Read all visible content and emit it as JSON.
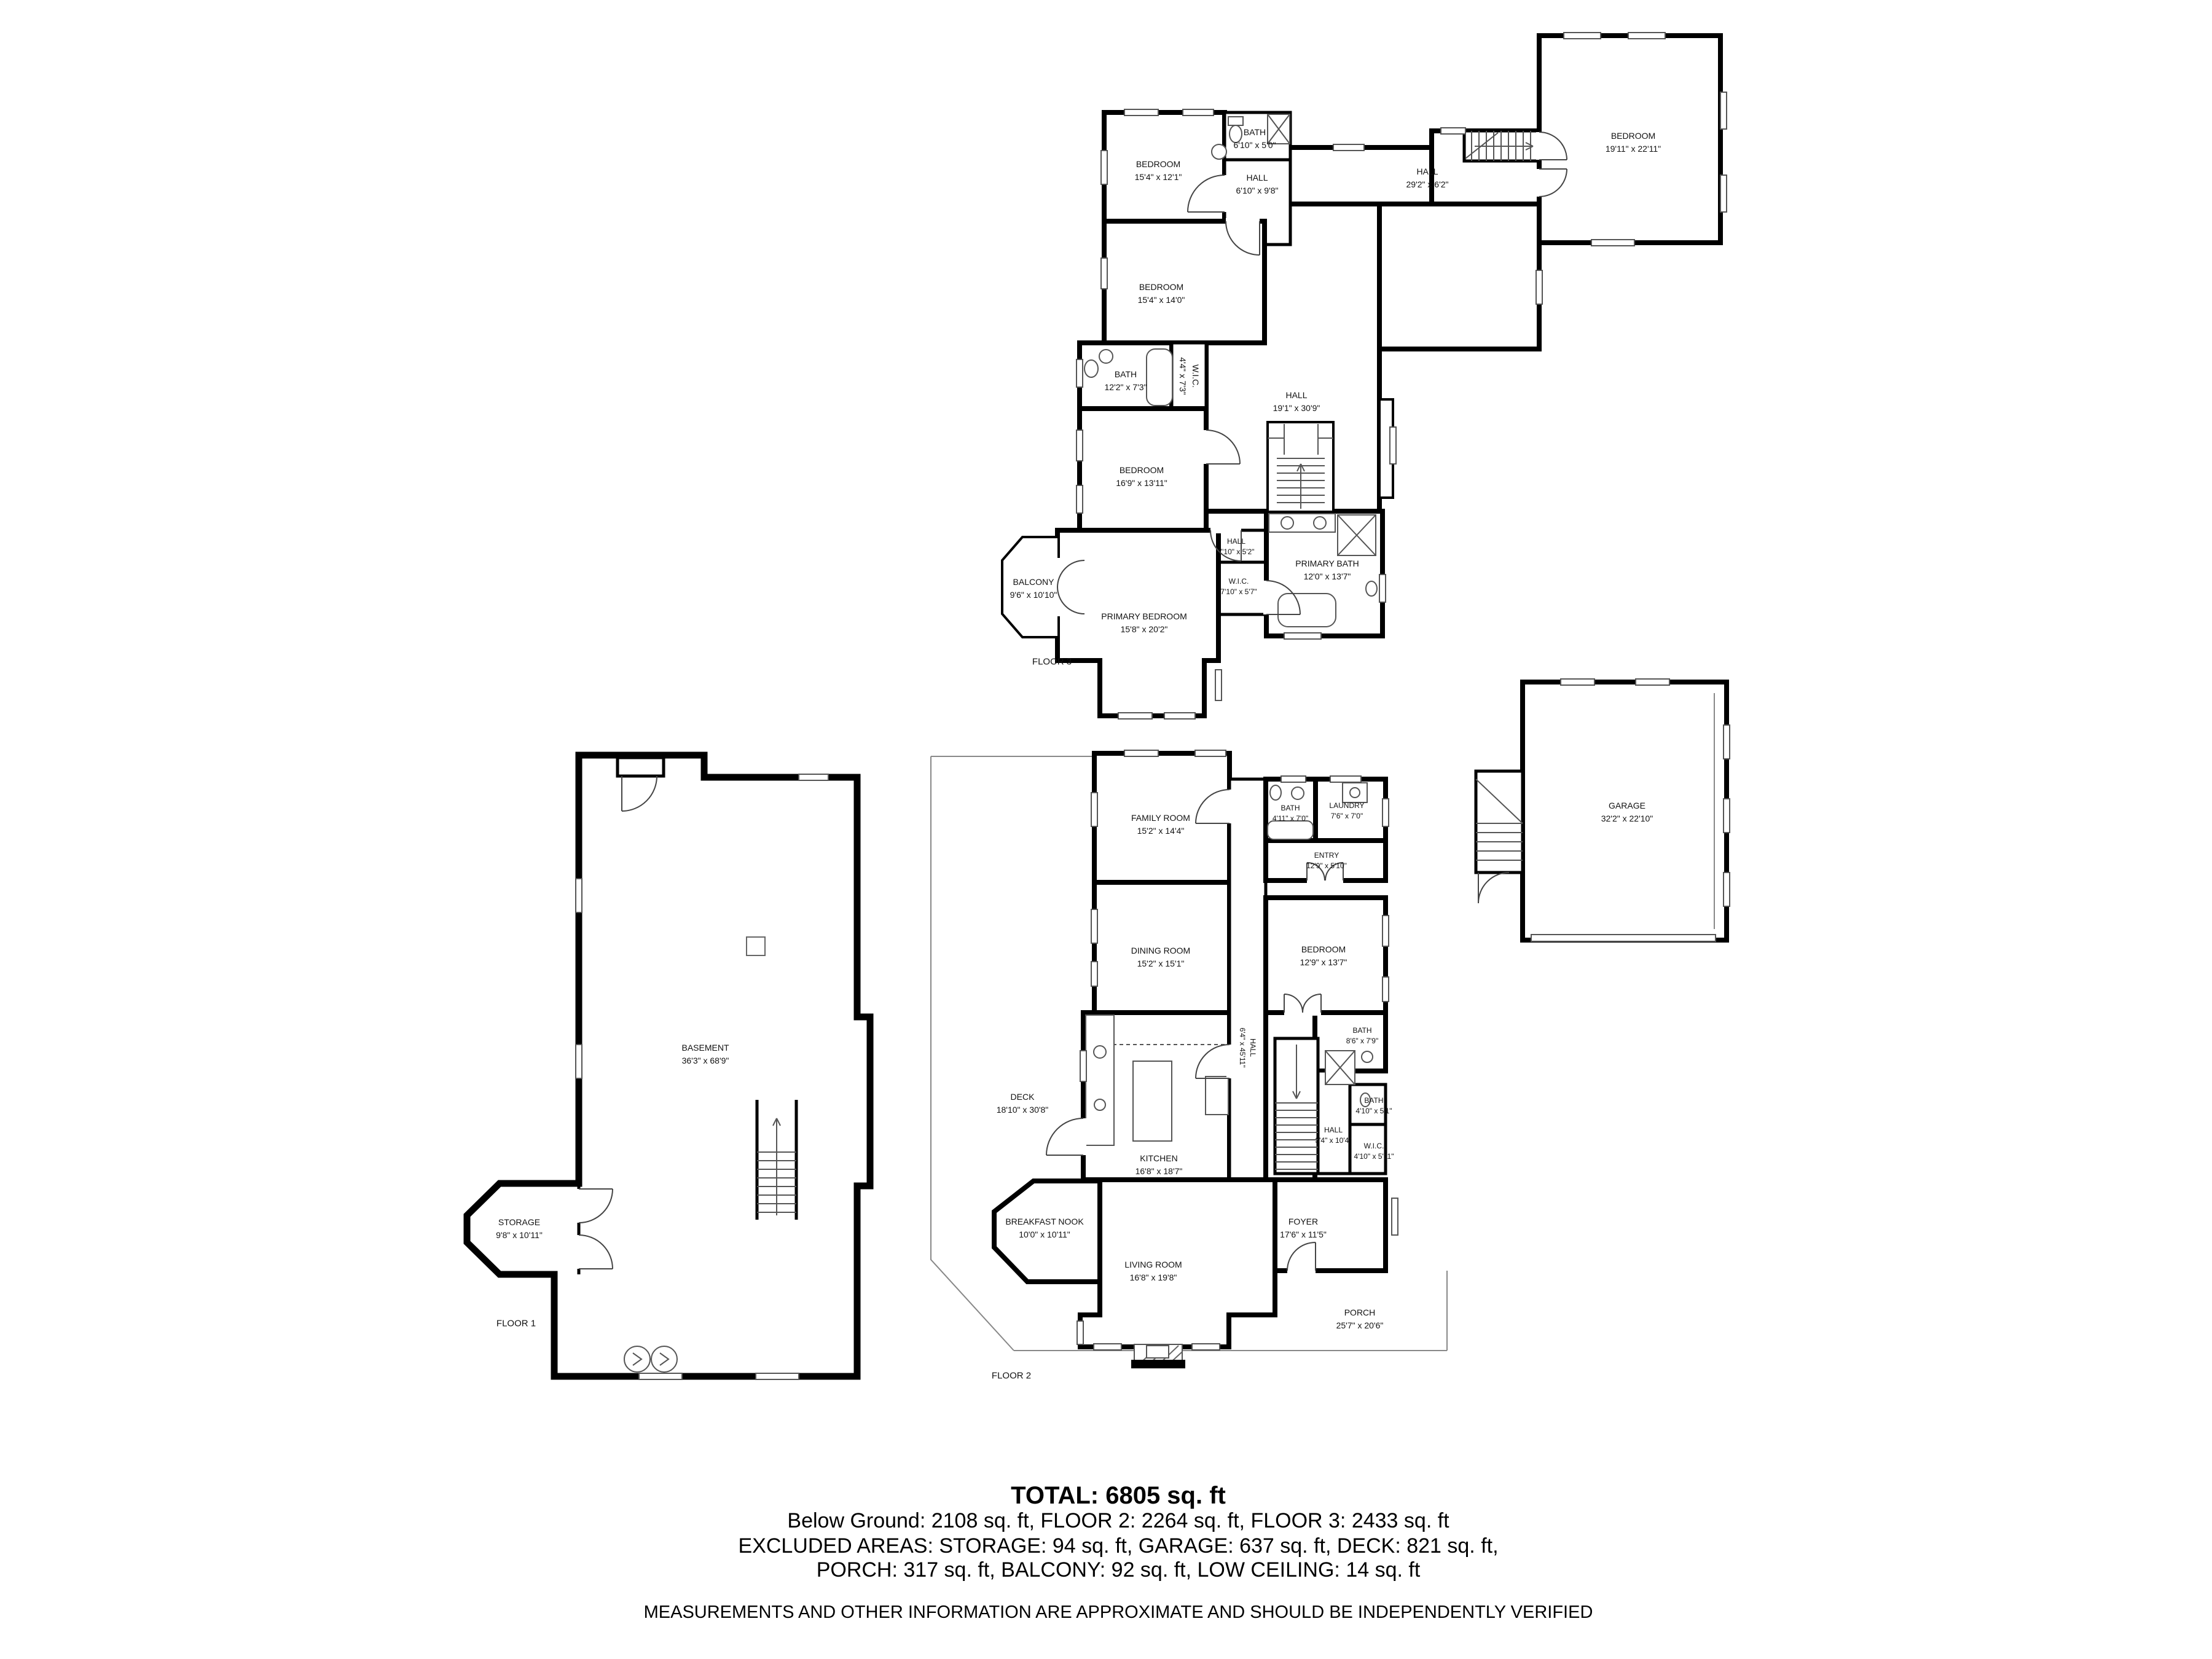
{
  "floors": {
    "floor3": {
      "label": "FLOOR 3",
      "rooms": {
        "bedroom_tl": {
          "name": "BEDROOM",
          "dims": "15'4\" x 12'1\""
        },
        "bath_top": {
          "name": "BATH",
          "dims": "6'10\" x 5'0\""
        },
        "hall_top": {
          "name": "HALL",
          "dims": "6'10\" x 9'8\""
        },
        "hall_corridor": {
          "name": "HALL",
          "dims": "29'2\" x 6'2\""
        },
        "bedroom_right": {
          "name": "BEDROOM",
          "dims": "19'11\" x 22'11\""
        },
        "bedroom_mid": {
          "name": "BEDROOM",
          "dims": "15'4\" x 14'0\""
        },
        "bath_mid": {
          "name": "BATH",
          "dims": "12'2\" x 7'3\""
        },
        "wic_small": {
          "name": "W.I.C.",
          "dims": "4'4\" x 7'3\""
        },
        "bedroom_low": {
          "name": "BEDROOM",
          "dims": "16'9\" x 13'11\""
        },
        "hall_main": {
          "name": "HALL",
          "dims": "19'1\" x 30'9\""
        },
        "hall_small": {
          "name": "HALL",
          "dims": "7'10\" x 5'2\""
        },
        "wic_primary": {
          "name": "W.I.C.",
          "dims": "7'10\" x 5'7\""
        },
        "primary_bath": {
          "name": "PRIMARY BATH",
          "dims": "12'0\" x 13'7\""
        },
        "balcony": {
          "name": "BALCONY",
          "dims": "9'6\" x 10'10\""
        },
        "primary_bedroom": {
          "name": "PRIMARY BEDROOM",
          "dims": "15'8\" x 20'2\""
        }
      }
    },
    "floor2": {
      "label": "FLOOR 2",
      "rooms": {
        "family": {
          "name": "FAMILY ROOM",
          "dims": "15'2\" x 14'4\""
        },
        "bath_small": {
          "name": "BATH",
          "dims": "4'11\" x 7'0\""
        },
        "laundry": {
          "name": "LAUNDRY",
          "dims": "7'6\" x 7'0\""
        },
        "entry": {
          "name": "ENTRY",
          "dims": "12'9\" x 5'10\""
        },
        "dining": {
          "name": "DINING ROOM",
          "dims": "15'2\" x 15'1\""
        },
        "bedroom": {
          "name": "BEDROOM",
          "dims": "12'9\" x 13'7\""
        },
        "deck": {
          "name": "DECK",
          "dims": "18'10\" x 30'8\""
        },
        "kitchen": {
          "name": "KITCHEN",
          "dims": "16'8\" x 18'7\""
        },
        "hall_long": {
          "name": "HALL",
          "dims": "6'4\" x 45'11\""
        },
        "bath_main": {
          "name": "BATH",
          "dims": "8'6\" x 7'9\""
        },
        "bath_tiny": {
          "name": "BATH",
          "dims": "4'10\" x 5'1\""
        },
        "hall_small": {
          "name": "HALL",
          "dims": "3'4\" x 10'4\""
        },
        "wic": {
          "name": "W.I.C.",
          "dims": "4'10\" x 5'11\""
        },
        "breakfast": {
          "name": "BREAKFAST NOOK",
          "dims": "10'0\" x 10'11\""
        },
        "living": {
          "name": "LIVING ROOM",
          "dims": "16'8\" x 19'8\""
        },
        "foyer": {
          "name": "FOYER",
          "dims": "17'6\" x 11'5\""
        },
        "porch": {
          "name": "PORCH",
          "dims": "25'7\" x 20'6\""
        }
      }
    },
    "floor1": {
      "label": "FLOOR 1",
      "rooms": {
        "basement": {
          "name": "BASEMENT",
          "dims": "36'3\" x 68'9\""
        },
        "storage": {
          "name": "STORAGE",
          "dims": "9'8\" x 10'11\""
        }
      }
    },
    "garage": {
      "name": "GARAGE",
      "dims": "32'2\" x 22'10\""
    }
  },
  "summary": {
    "total": "TOTAL: 6805 sq. ft",
    "line2": "Below Ground: 2108 sq. ft, FLOOR 2: 2264 sq. ft, FLOOR 3: 2433 sq. ft",
    "line3": "EXCLUDED AREAS: STORAGE: 94 sq. ft, GARAGE: 637 sq. ft, DECK: 821 sq. ft,",
    "line4": "PORCH: 317 sq. ft, BALCONY: 92 sq. ft, LOW CEILING: 14 sq. ft",
    "disclaimer": "MEASUREMENTS AND OTHER INFORMATION ARE APPROXIMATE AND SHOULD BE INDEPENDENTLY VERIFIED"
  }
}
